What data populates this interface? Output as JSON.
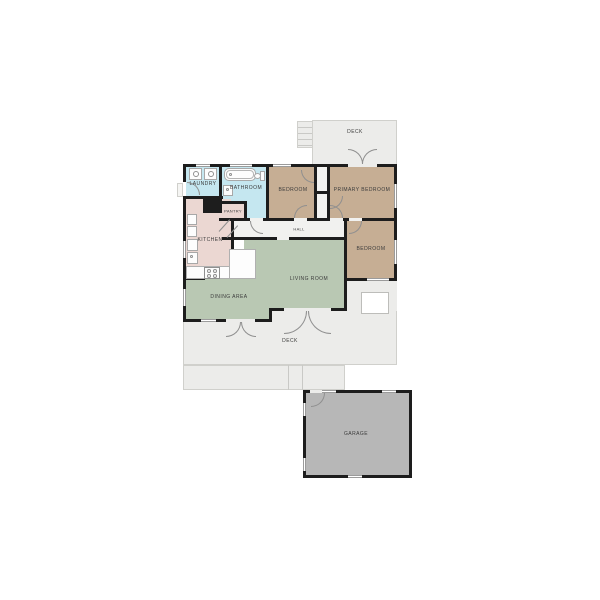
{
  "plan_title": "Floor plan",
  "rooms": {
    "deck_top": {
      "label": "DECK"
    },
    "laundry": {
      "label": "LAUNDRY"
    },
    "bathroom": {
      "label": "BATHROOM"
    },
    "bedroom_top": {
      "label": "BEDROOM"
    },
    "primary_bedroom": {
      "label": "PRIMARY BEDROOM"
    },
    "pantry": {
      "label": "PANTRY"
    },
    "hall": {
      "label": "HALL"
    },
    "kitchen": {
      "label": "KITCHEN"
    },
    "bedroom_right": {
      "label": "BEDROOM"
    },
    "living_room": {
      "label": "LIVING ROOM"
    },
    "dining_area": {
      "label": "DINING AREA"
    },
    "deck_bottom": {
      "label": "DECK"
    },
    "garage": {
      "label": "GARAGE"
    }
  },
  "colors": {
    "bedroom": "#c6ae94",
    "living": "#b9c8b3",
    "kitchen": "#ebd7d2",
    "bathroom": "#c5e7f0",
    "deck": "#ececea",
    "garage": "#b7b7b7",
    "wall": "#1d1d1d",
    "label": "#3b3b3b"
  }
}
